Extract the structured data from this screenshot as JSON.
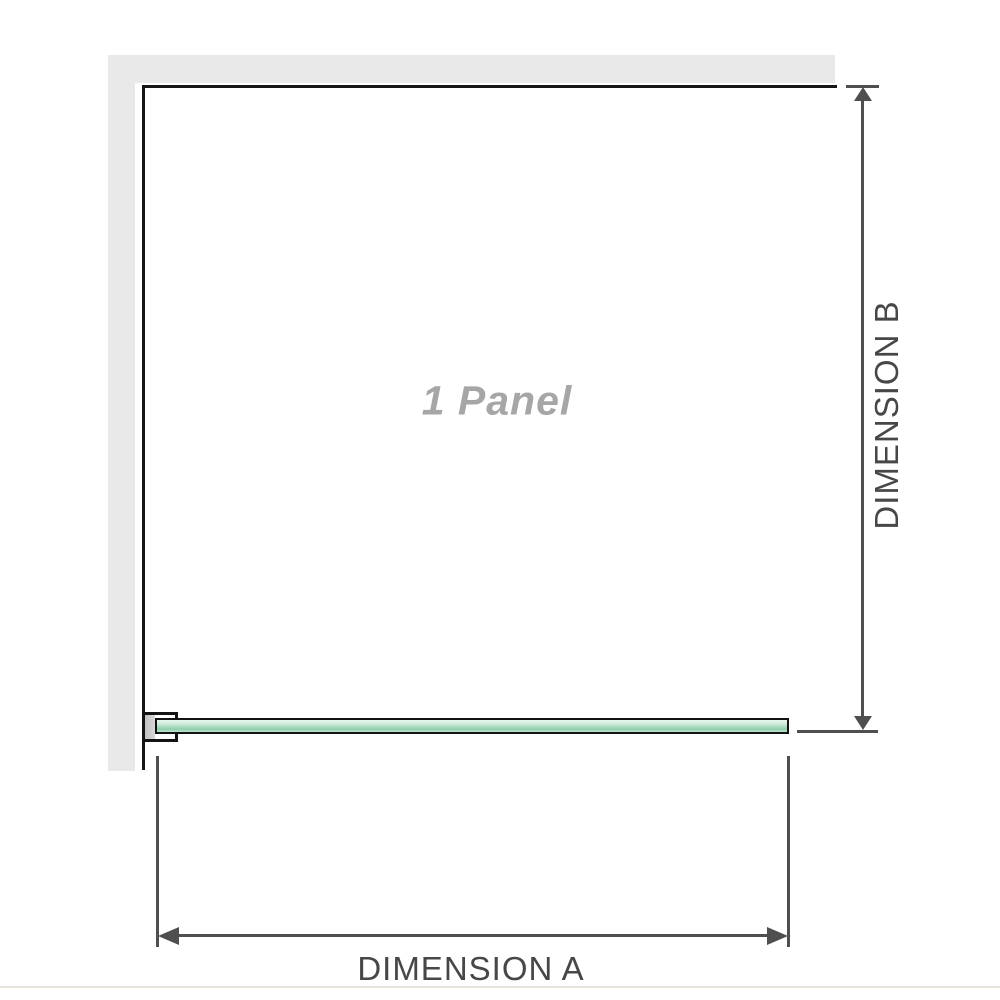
{
  "diagram": {
    "panel_label": "1 Panel",
    "dimension_a": {
      "label": "DIMENSION A"
    },
    "dimension_b": {
      "label": "DIMENSION B"
    }
  },
  "colors": {
    "wall": "#e9e9e9",
    "panel_outline": "#161616",
    "dimension_lines": "#4f4f4f",
    "dimension_text": "#474747",
    "watermark_text": "#a6a6a6",
    "glass_light": "#cdeadb",
    "glass_dark": "#8fceac",
    "bracket_pad": "#c9c9c9",
    "baseline_rule": "#e8e4dd"
  },
  "icons": {
    "arrow_up": "up-arrowhead",
    "arrow_down": "down-arrowhead",
    "arrow_left": "left-arrowhead",
    "arrow_right": "right-arrowhead"
  }
}
